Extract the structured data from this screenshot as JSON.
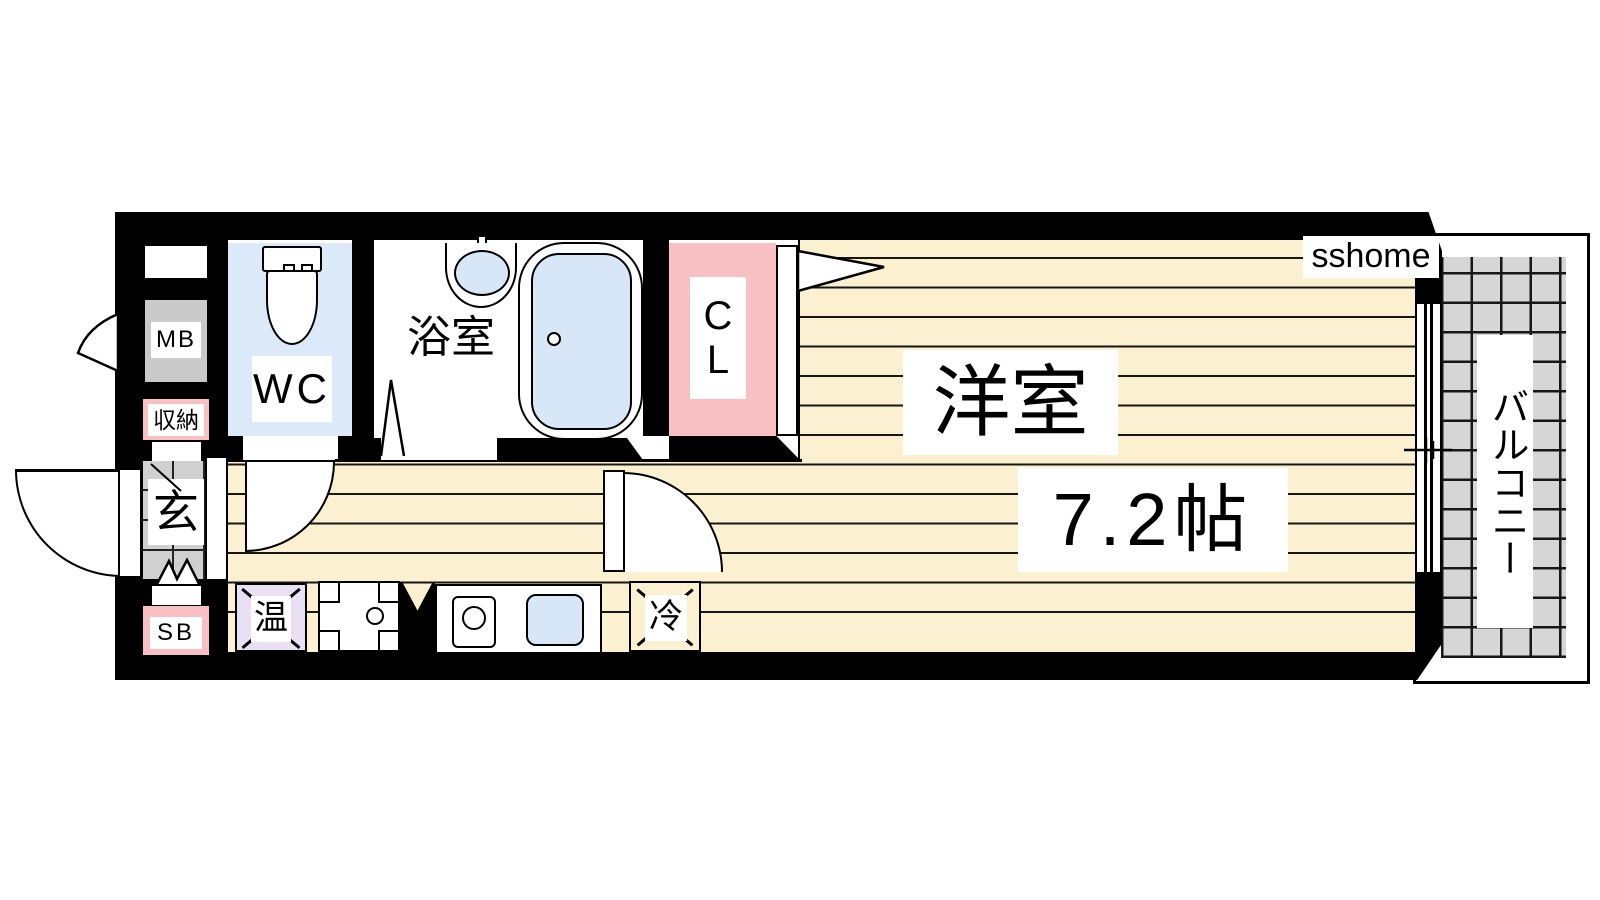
{
  "page": {
    "background": "#ffffff",
    "watermark": "sshome"
  },
  "floorplan": {
    "type": "apartment-1K-floor-plan",
    "labels": {
      "meter_box": "MB",
      "storage": "収納",
      "entrance": "玄",
      "shoe_box": "SB",
      "toilet_room": "WC",
      "bathroom": "浴室",
      "closet": "CL",
      "main_room": "洋室",
      "main_room_size": "7.2帖",
      "water_heater": "温",
      "refrigerator": "冷",
      "balcony": "バルコニー"
    },
    "colors": {
      "wall": "#000000",
      "floor_cream": "#FBF0D0",
      "floor_stripe_line": "#161616",
      "wet_area_blue": "#DCE9F8",
      "fixture_blue": "#D8E7F8",
      "closet_pink": "#F9C0C4",
      "water_heater_lavender": "#E9E0F4",
      "meter_box_gray": "#C9C9C9",
      "entrance_tile_gray": "#D0D0D0",
      "balcony_tile_gray": "#D6D6D6"
    }
  }
}
